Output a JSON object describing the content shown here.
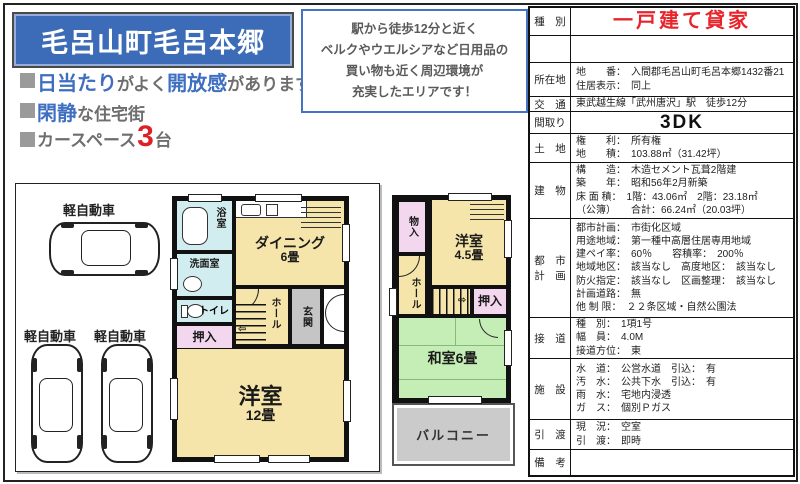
{
  "header": {
    "title": "毛呂山町毛呂本郷",
    "bullet1": {
      "hl1": "日当たり",
      "t1": "がよく",
      "hl2": "開放感",
      "t2": "があります"
    },
    "bullet2": {
      "hl1": "閑静",
      "t1": "な住宅街"
    },
    "bullet3": {
      "t1": "カースペース",
      "num": "3",
      "t2": "台"
    }
  },
  "callout": {
    "line1": "駅から徒歩12分と近く",
    "line2": "ベルクやウエルシアなど日用品の",
    "line3": "買い物も近く周辺環境が",
    "line4": "充実したエリアです！"
  },
  "spec": {
    "type": {
      "label": "種　別",
      "value": "一戸建て貸家"
    },
    "address": {
      "label": "所在地",
      "line1": "地　　番：　入間郡毛呂山町毛呂本郷1432番21",
      "line2": "住居表示：　同上"
    },
    "access": {
      "label": "交　通",
      "value": "東武越生線「武州唐沢」駅　徒歩12分"
    },
    "madori": {
      "label": "間取り",
      "value": "3DK"
    },
    "land": {
      "label": "土　地",
      "line1": "権　　利：　所有権",
      "line2": "地　　積：　103.88㎡（31.42坪）"
    },
    "building": {
      "label": "建　物",
      "line1": "構　　造：　木造セメント瓦葺2階建",
      "line2": "築　　年：　昭和56年2月新築",
      "line3": "床 面 積：　1階：43.06㎡　2階：23.18㎡",
      "line4": "（公簿）　　合計：66.24㎡（20.03坪）"
    },
    "city": {
      "label1": "都　市",
      "label2": "計　画",
      "line1": "都市計画：　市街化区域",
      "line2": "用途地域：　第一種中高層住居専用地域",
      "line3": "建ペイ率：　60％　　容積率：　200％",
      "line4": "地域地区：　該当なし　高度地区：　該当なし",
      "line5": "防火指定：　該当なし　区画整理：　該当なし",
      "line6": "計画道路：　無",
      "line7": "他 制 限：　２２条区域・自然公園法"
    },
    "road": {
      "label": "接　道",
      "line1": "種　別：　1項1号",
      "line2": "幅　員：　4.0M",
      "line3": "接道方位：　東"
    },
    "facilities": {
      "label": "施　設",
      "line1": "水　道：　公営水道　引込：　有",
      "line2": "汚　水：　公共下水　引込：　有",
      "line3": "雨　水：　宅地内浸透",
      "line4": "ガ　ス：　個別Ｐガス"
    },
    "handover": {
      "label": "引　渡",
      "line1": "現　況：　空室",
      "line2": "引　渡：　即時"
    },
    "notes": {
      "label": "備　考",
      "value": ""
    }
  },
  "plan": {
    "car1": "軽自動車",
    "car2": "軽自動車",
    "car3": "軽自動車",
    "f1": {
      "bath": "浴室",
      "wash": "洗面室",
      "wc": "トイレ",
      "oshiire": "押入",
      "dining": "ダイニング",
      "dining_size": "6畳",
      "hall": "ホール",
      "genkan": "玄関",
      "west": "洋室",
      "west_size": "12畳"
    },
    "f2": {
      "mono": "物入",
      "west": "洋室",
      "west_size": "4.5畳",
      "hall": "ホール",
      "oshiire": "押入",
      "washitsu": "和室6畳",
      "balcony": "バルコニー"
    }
  },
  "colors": {
    "banner_bg": "#3c6cb8",
    "highlight_blue": "#3f6fc1",
    "accent_red": "#dd2026",
    "text_gray": "#6e6e6e",
    "callout_border": "#4472c4",
    "spec_type_red": "#e8232a",
    "room_cream": "#f5e5aa",
    "room_blue": "#d2edf0",
    "room_pink": "#f3d7ee",
    "room_green": "#c5edb6",
    "room_gray": "#c5c5c5"
  }
}
